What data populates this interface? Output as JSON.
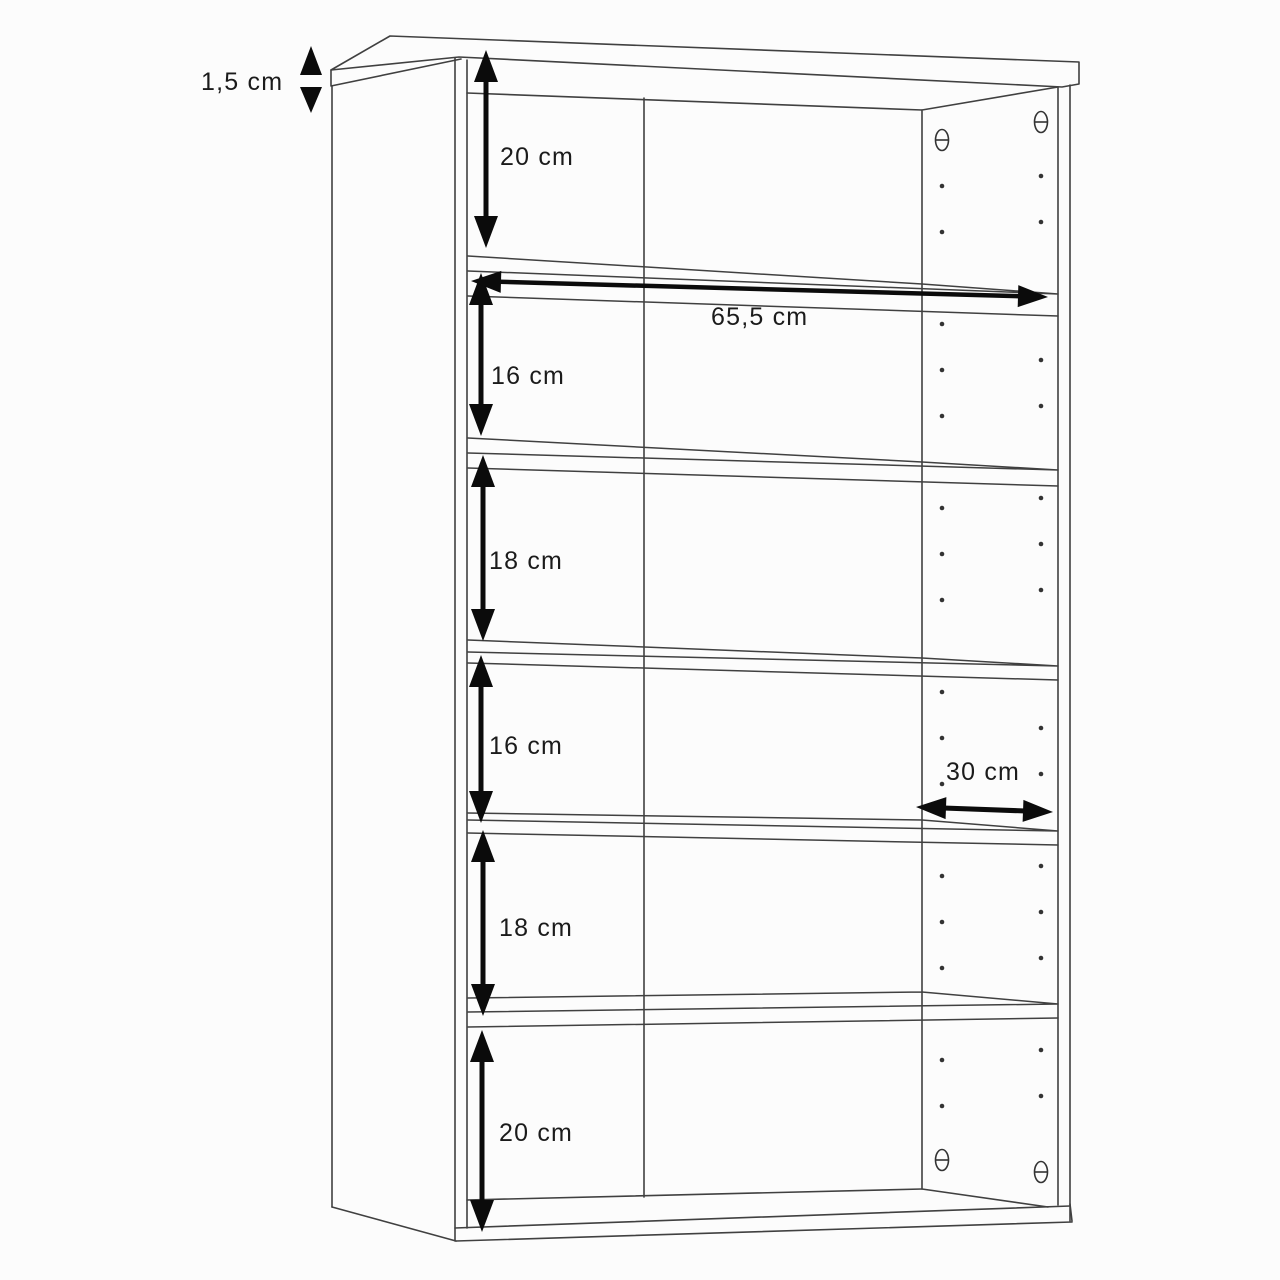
{
  "diagram": {
    "type": "furniture-technical-drawing",
    "subject": "shelf cabinet with five shelves and peg holes, dimensioned",
    "unit": "cm",
    "dimensions": {
      "top_panel_thickness": "1,5 cm",
      "inner_width": "65,5 cm",
      "depth": "30 cm",
      "compartment_heights": [
        "20 cm",
        "16 cm",
        "18 cm",
        "16 cm",
        "18 cm",
        "20 cm"
      ]
    },
    "colors": {
      "background": "#fcfcfc",
      "line": "#404040",
      "arrow": "#0b0b0b",
      "text": "#1b1b1b"
    },
    "labels": [
      {
        "id": "thickness",
        "text": "1,5 cm",
        "x": 201,
        "y": 90
      },
      {
        "id": "comp1",
        "text": "20 cm",
        "x": 500,
        "y": 165
      },
      {
        "id": "width",
        "text": "65,5 cm",
        "x": 711,
        "y": 325
      },
      {
        "id": "comp2",
        "text": "16 cm",
        "x": 491,
        "y": 384
      },
      {
        "id": "comp3",
        "text": "18 cm",
        "x": 489,
        "y": 569
      },
      {
        "id": "comp4",
        "text": "16 cm",
        "x": 489,
        "y": 754
      },
      {
        "id": "depth",
        "text": "30 cm",
        "x": 946,
        "y": 780
      },
      {
        "id": "comp5",
        "text": "18 cm",
        "x": 499,
        "y": 936
      },
      {
        "id": "comp6",
        "text": "20 cm",
        "x": 499,
        "y": 1141
      }
    ],
    "v_arrows": [
      {
        "id": "arrow-20cm-top",
        "x": 486,
        "y1": 50,
        "y2": 248,
        "dim": "20 cm"
      },
      {
        "id": "arrow-16cm-upper",
        "x": 481,
        "y1": 273,
        "y2": 436,
        "dim": "16 cm"
      },
      {
        "id": "arrow-18cm-upper",
        "x": 483,
        "y1": 455,
        "y2": 641,
        "dim": "18 cm"
      },
      {
        "id": "arrow-16cm-lower",
        "x": 481,
        "y1": 655,
        "y2": 823,
        "dim": "16 cm"
      },
      {
        "id": "arrow-18cm-lower",
        "x": 483,
        "y1": 830,
        "y2": 1016,
        "dim": "18 cm"
      },
      {
        "id": "arrow-20cm-bottom",
        "x": 482,
        "y1": 1030,
        "y2": 1232,
        "dim": "20 cm"
      }
    ],
    "h_arrows": [
      {
        "id": "arrow-width-65-5",
        "x1": 471,
        "y1": 281,
        "x2": 1048,
        "y2": 297,
        "dim": "65,5 cm",
        "shaft": 4.5
      },
      {
        "id": "arrow-depth-30",
        "x1": 916,
        "y1": 807,
        "x2": 1053,
        "y2": 812,
        "dim": "30 cm",
        "shaft": 5
      }
    ],
    "thickness_indicator": {
      "dim": "1,5 cm",
      "x": 311,
      "apex_top": 46,
      "base_top": 75,
      "base_bottom": 87,
      "apex_bottom": 113,
      "half_width": 11,
      "tick_y": 80
    }
  }
}
